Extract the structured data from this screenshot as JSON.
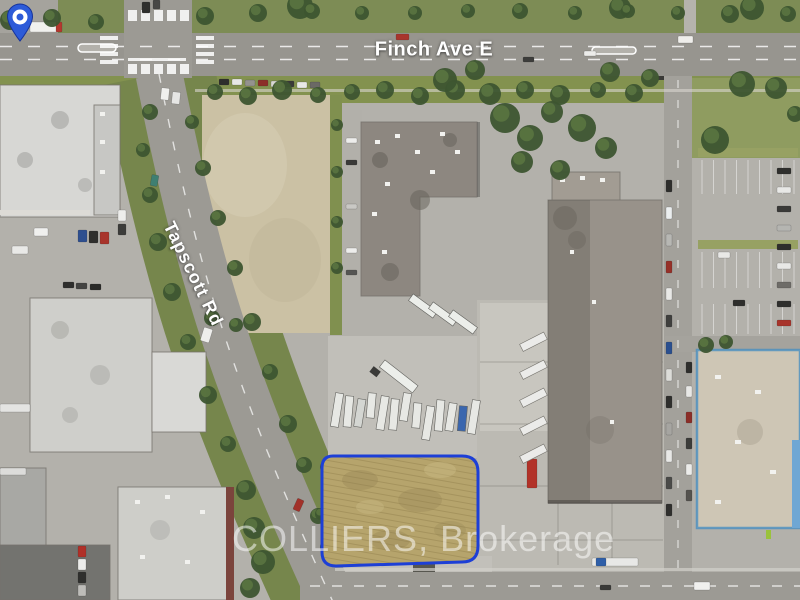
{
  "streets": {
    "finch": "Finch Ave E",
    "tapscott": "Tapscott Rd"
  },
  "watermark": {
    "text": "COLLIERS, Brokerage",
    "color": "#ffffff"
  },
  "icons": {
    "pin": "location-pin-icon"
  },
  "colors": {
    "property_outline": "#1d3fd6",
    "pin_fill": "#2d5bd8",
    "pin_ring": "#ffffff",
    "grass": "#7c8b50",
    "road": "#9c9a94",
    "field": "#b6a46c"
  }
}
